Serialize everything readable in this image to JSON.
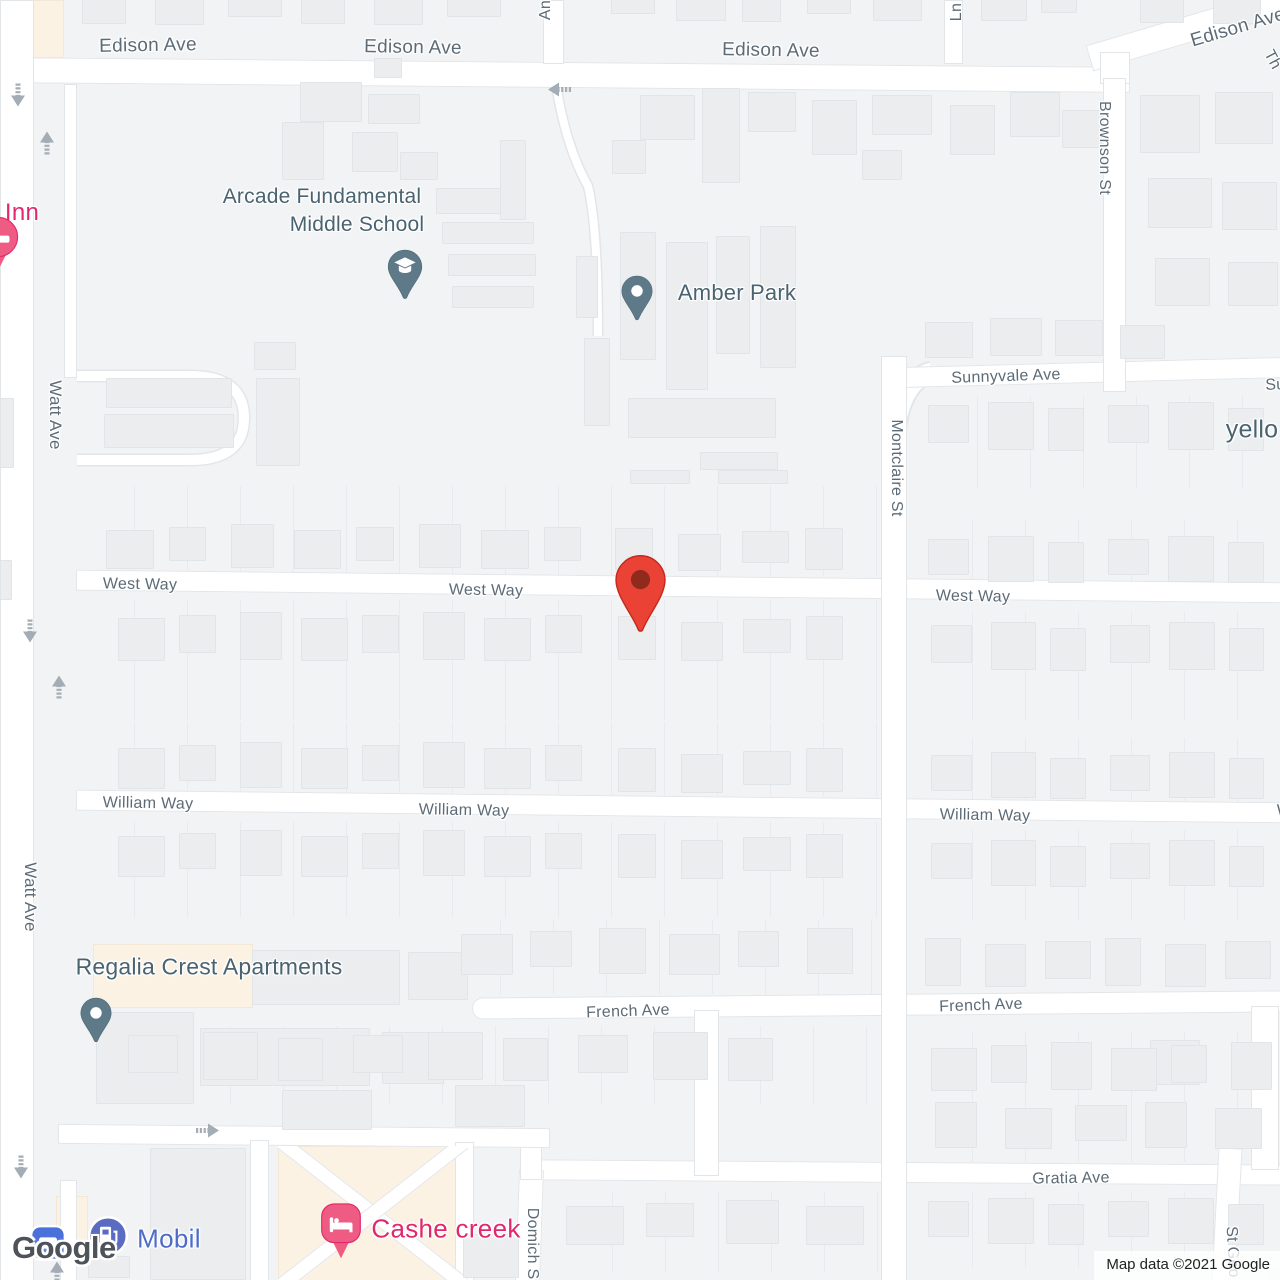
{
  "app": {
    "watermark": "Google",
    "attribution": "Map data ©2021 Google"
  },
  "labels": {
    "roads": [
      {
        "text": "Edison Ave",
        "x": 148,
        "y": 46,
        "rot": -1,
        "size": 19
      },
      {
        "text": "Edison Ave",
        "x": 413,
        "y": 48,
        "rot": 1,
        "size": 19
      },
      {
        "text": "Edison Ave",
        "x": 771,
        "y": 51,
        "rot": 1,
        "size": 19
      },
      {
        "text": "Edison Ave",
        "x": 1238,
        "y": 28,
        "rot": -16.5,
        "size": 19
      },
      {
        "text": "Watt Ave",
        "x": 55,
        "y": 415,
        "rot": 90,
        "size": 17
      },
      {
        "text": "Watt Ave",
        "x": 30,
        "y": 897,
        "rot": 90,
        "size": 17
      },
      {
        "text": "Sunnyvale Ave",
        "x": 1006,
        "y": 377,
        "rot": -2,
        "size": 16
      },
      {
        "text": "Sunnyvale Ave",
        "x": 1320,
        "y": 384,
        "rot": -2,
        "size": 16
      },
      {
        "text": "Montclaire St",
        "x": 896,
        "y": 468,
        "rot": 90,
        "size": 16
      },
      {
        "text": "Brownson St",
        "x": 1104,
        "y": 148,
        "rot": 90,
        "size": 16
      },
      {
        "text": "West Way",
        "x": 140,
        "y": 585,
        "rot": 1,
        "size": 16
      },
      {
        "text": "West Way",
        "x": 486,
        "y": 591,
        "rot": 1,
        "size": 16
      },
      {
        "text": "West Way",
        "x": 973,
        "y": 597,
        "rot": 1,
        "size": 16
      },
      {
        "text": "William Way",
        "x": 148,
        "y": 804,
        "rot": 1,
        "size": 16
      },
      {
        "text": "William Way",
        "x": 464,
        "y": 811,
        "rot": 1,
        "size": 16
      },
      {
        "text": "William Way",
        "x": 985,
        "y": 816,
        "rot": 1,
        "size": 16
      },
      {
        "text": "William Way",
        "x": 1322,
        "y": 812,
        "rot": 1,
        "size": 16
      },
      {
        "text": "French Ave",
        "x": 628,
        "y": 1012,
        "rot": -2,
        "size": 16
      },
      {
        "text": "French Ave",
        "x": 981,
        "y": 1006,
        "rot": -2,
        "size": 16
      },
      {
        "text": "Gratia Ave",
        "x": 1071,
        "y": 1179,
        "rot": -1,
        "size": 16
      },
      {
        "text": "Ln",
        "x": 957,
        "y": 12,
        "rot": -90,
        "size": 16
      },
      {
        "text": "An",
        "x": 546,
        "y": 10,
        "rot": -90,
        "size": 16
      },
      {
        "text": "Domich St",
        "x": 532,
        "y": 1246,
        "rot": 90,
        "size": 16
      },
      {
        "text": "St Geo",
        "x": 1232,
        "y": 1252,
        "rot": 87,
        "size": 16
      },
      {
        "text": "Th",
        "x": 1272,
        "y": 60,
        "rot": 62,
        "size": 16
      }
    ],
    "pois": [
      {
        "text": "Arcade Fundamental",
        "x": 322,
        "y": 197,
        "size": 21
      },
      {
        "text": "Middle School",
        "x": 357,
        "y": 225,
        "size": 21
      },
      {
        "text": "Amber Park",
        "x": 737,
        "y": 293,
        "size": 22
      },
      {
        "text": "Regalia Crest Apartments",
        "x": 209,
        "y": 967,
        "size": 23
      },
      {
        "text": "yello",
        "x": 1252,
        "y": 430,
        "size": 25
      }
    ],
    "pois_pink": [
      {
        "text": "Inn",
        "x": 22,
        "y": 213,
        "size": 24
      },
      {
        "text": "Cashe creek",
        "x": 446,
        "y": 1229,
        "size": 26
      }
    ],
    "pois_blue": [
      {
        "text": "Mobil",
        "x": 169,
        "y": 1239,
        "size": 26
      }
    ]
  },
  "markers": [
    {
      "name": "destination-pin",
      "type": "red-pin",
      "x": 640,
      "y": 637
    },
    {
      "name": "school-pin",
      "type": "slate-pin-school",
      "x": 405,
      "y": 301
    },
    {
      "name": "park-pin",
      "type": "slate-pin-dot",
      "x": 637,
      "y": 322
    },
    {
      "name": "apartments-pin",
      "type": "slate-pin-dot",
      "x": 96,
      "y": 1044
    },
    {
      "name": "gas-station-icon",
      "type": "blue-circle-fuel",
      "x": 108,
      "y": 1236
    },
    {
      "name": "hotel-pin",
      "type": "pink-pin-bed",
      "x": 341,
      "y": 1260
    },
    {
      "name": "hotel-pin-clipped",
      "type": "pink-circle-bed",
      "x": -2,
      "y": 272
    },
    {
      "name": "poi-square-icon",
      "type": "blue-square",
      "x": 48,
      "y": 1243
    }
  ],
  "arrows": [
    {
      "x": 18,
      "y": 97,
      "dir": "down"
    },
    {
      "x": 47,
      "y": 146,
      "dir": "up"
    },
    {
      "x": 560,
      "y": 92,
      "dir": "left"
    },
    {
      "x": 30,
      "y": 633,
      "dir": "down"
    },
    {
      "x": 59,
      "y": 690,
      "dir": "up"
    },
    {
      "x": 21,
      "y": 1169,
      "dir": "down"
    },
    {
      "x": 207,
      "y": 1133,
      "dir": "right"
    },
    {
      "x": 57,
      "y": 1276,
      "dir": "up"
    }
  ],
  "colors": {
    "land": "#F2F3F5",
    "road": "#FFFFFF",
    "road_casing": "#E3E6E9",
    "building": "#EBEDEF",
    "building_border": "#E2E5E8",
    "commercial": "#FBF2E3",
    "road_label": "#5D6B77",
    "poi_label": "#4A6370",
    "poi_pink": "#E0286C",
    "poi_blue": "#4D6BC7",
    "pin_red": "#EA4335",
    "pin_red_dot": "#8F2A1C",
    "pin_slate": "#5E7988",
    "pin_pink": "#EE5B83",
    "icon_blue": "#5A6BC2",
    "arrow": "#A4ADB5"
  }
}
